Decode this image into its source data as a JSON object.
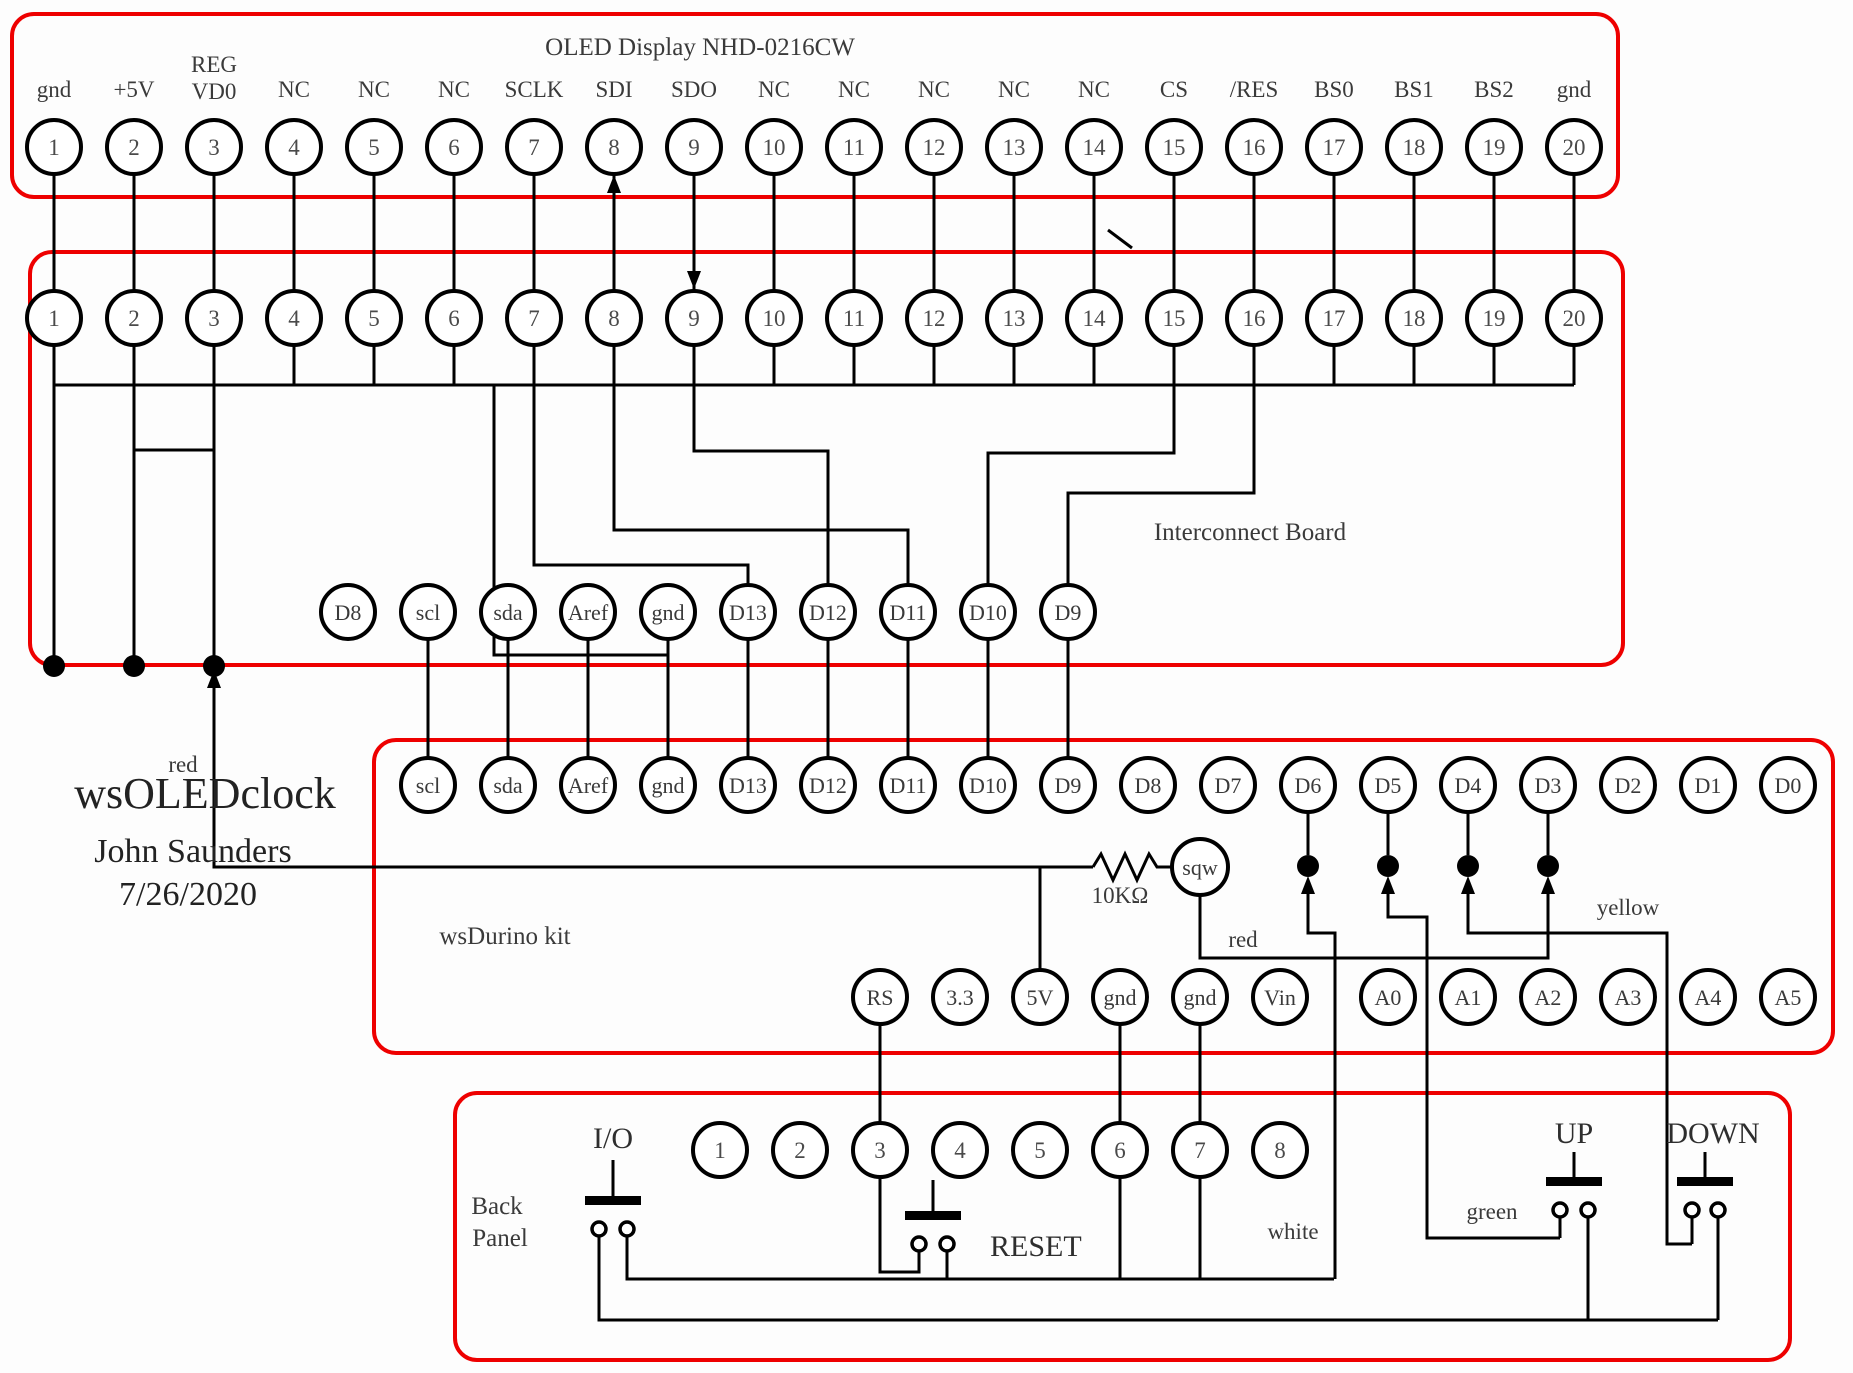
{
  "colors": {
    "box_red": "#ee0000",
    "wire_black": "#000000",
    "text_gray": "#3a3a3a"
  },
  "nums": [
    "1",
    "2",
    "3",
    "4",
    "5",
    "6",
    "7",
    "8",
    "9",
    "10",
    "11",
    "12",
    "13",
    "14",
    "15",
    "16",
    "17",
    "18",
    "19",
    "20"
  ],
  "oled": {
    "title": "OLED Display NHD-0216CW",
    "reg": [
      "REG",
      "VD0"
    ],
    "labels": [
      "gnd",
      "+5V",
      "",
      "NC",
      "NC",
      "NC",
      "SCLK",
      "SDI",
      "SDO",
      "NC",
      "NC",
      "NC",
      "NC",
      "NC",
      "CS",
      "/RES",
      "BS0",
      "BS1",
      "BS2",
      "gnd"
    ]
  },
  "interconnect": {
    "title": "Interconnect Board",
    "header": [
      "D8",
      "scl",
      "sda",
      "Aref",
      "gnd",
      "D13",
      "D12",
      "D11",
      "D10",
      "D9"
    ]
  },
  "wsdurino": {
    "title": "wsDurino kit",
    "top": [
      "scl",
      "sda",
      "Aref",
      "gnd",
      "D13",
      "D12",
      "D11",
      "D10",
      "D9",
      "D8",
      "D7",
      "D6",
      "D5",
      "D4",
      "D3",
      "D2",
      "D1",
      "D0"
    ],
    "bottom": [
      "RS",
      "3.3",
      "5V",
      "gnd",
      "gnd",
      "Vin",
      "A0",
      "A1",
      "A2",
      "A3",
      "A4",
      "A5"
    ],
    "sqw": "sqw",
    "resistor": "10KΩ"
  },
  "backpanel": {
    "title": [
      "Back",
      "Panel"
    ],
    "io": "I/O",
    "reset": "RESET",
    "up": "UP",
    "down": "DOWN"
  },
  "wire_labels": {
    "red_left": "red",
    "red_right": "red",
    "yellow": "yellow",
    "green": "green",
    "white": "white"
  },
  "title_block": {
    "line1": "wsOLEDclock",
    "line2": "John Saunders",
    "line3": "7/26/2020"
  }
}
